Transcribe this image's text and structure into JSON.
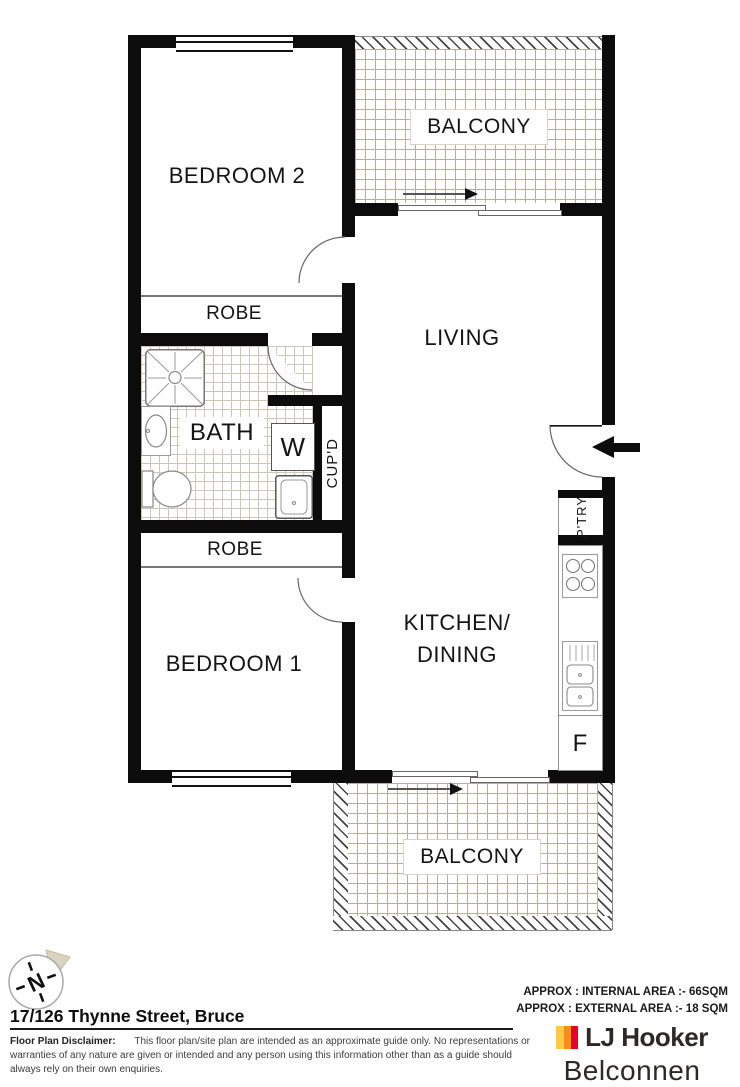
{
  "plan": {
    "rooms": {
      "bedroom2": "BEDROOM 2",
      "balcony_top": "BALCONY",
      "robe_top": "ROBE",
      "living": "LIVING",
      "bath": "BATH",
      "washer": "W",
      "cupboard": "CUP'D",
      "robe_bottom": "ROBE",
      "bedroom1": "BEDROOM 1",
      "kitchen_line1": "KITCHEN/",
      "kitchen_line2": "DINING",
      "pantry": "P'TRY",
      "fridge": "F",
      "balcony_bottom": "BALCONY"
    },
    "compass": {
      "label": "N"
    }
  },
  "footer": {
    "address": "17/126 Thynne Street, Bruce",
    "disclaimer": {
      "label": "Floor Plan Disclaimer:",
      "line1": "This floor plan/site plan are intended as an approximate guide only. No representations or",
      "line2": "warranties of any nature are given or intended and any person using this information other than as a guide should",
      "line3": "always rely on their own enquiries."
    },
    "areas": {
      "internal": "APPROX : INTERNAL AREA :- 66SQM",
      "external": "APPROX : EXTERNAL AREA :- 18 SQM"
    },
    "brand": {
      "name": "LJ Hooker",
      "office": "Belconnen",
      "stripe_colors": [
        "#FFC845",
        "#F68B1F",
        "#E4002B"
      ],
      "text_color": "#2D2926"
    }
  }
}
